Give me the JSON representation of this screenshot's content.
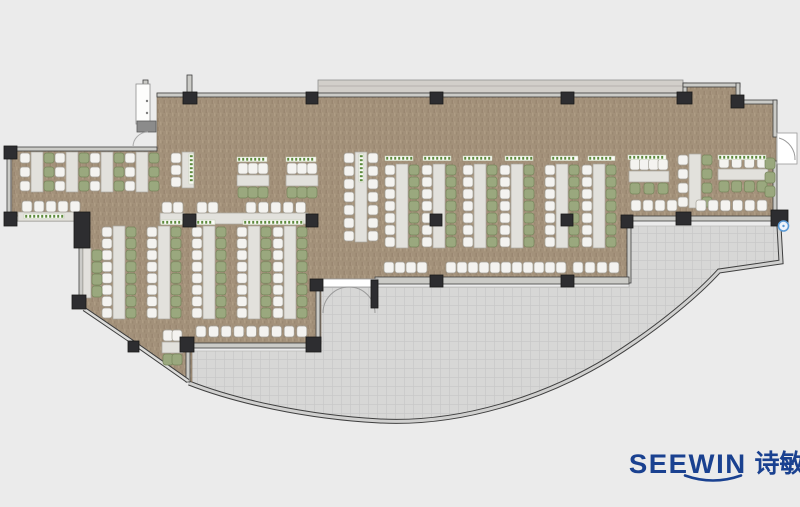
{
  "meta": {
    "type": "office-floor-plan",
    "description": "Open office cafeteria floor plan with desk clusters, curved curtain-wall terrace"
  },
  "logo": {
    "latin": "SEEWIN",
    "cjk": "诗敏",
    "color": "#1a4190"
  },
  "palette": {
    "background": "#ebebeb",
    "carpet": "#a3917a",
    "carpet_dark": "#917f68",
    "carpet_light": "#b5a38c",
    "terrace": "#d7d7d6",
    "terrace_grid": "#c8c8c7",
    "wall_fill": "#cbcbc7",
    "wall_line": "#3f3f3f",
    "column": "#2d2d30",
    "desk": "#e2e1dc",
    "desk_line": "#a9a79f",
    "chair_white": "#f4f3f0",
    "chair_white_line": "#a29f96",
    "chair_green": "#9aa87e",
    "chair_green_line": "#76855b",
    "label_green": "#5c8a3c",
    "ledge": "#d2cfca",
    "marker_blue": "#5b9bd5",
    "door_white": "#ffffff"
  },
  "plan": {
    "floor_path": "M157,93 L683,93 L683,83 L737,83 L737,101 L776,101 L776,219 L629,219 L629,282 L321,282 L321,344 L192,344 L192,382 L131,341 L84,308 L84,221 L12,221 L12,151 L157,151 Z",
    "terrace_path": "M190,351 L317,351 L317,287 L629,287 L629,226 L778,226 L780,262 L719,271 C700,292 660,327 610,358 C545,398 460,425 380,421 C305,417 235,401 190,383 Z",
    "arc_path": "M189,383 C235,401 305,417 380,421 C460,425 545,398 610,358 C660,327 700,292 719,271 L781,262 L779,226",
    "glass_points": "84,309 131,341 188,381",
    "ledge": [
      318,
      80,
      365,
      13
    ],
    "walls": [
      [
        157,
        93,
        526,
        4
      ],
      [
        683,
        83,
        4,
        14
      ],
      [
        683,
        83,
        57,
        4
      ],
      [
        736,
        83,
        4,
        21
      ],
      [
        736,
        100,
        41,
        4
      ],
      [
        773,
        100,
        4,
        37
      ],
      [
        773,
        161,
        4,
        53
      ],
      [
        627,
        216,
        150,
        5
      ],
      [
        627,
        221,
        4,
        62
      ],
      [
        375,
        277,
        254,
        7
      ],
      [
        316,
        287,
        4,
        53
      ],
      [
        191,
        343,
        127,
        5
      ],
      [
        186,
        348,
        4,
        34
      ],
      [
        79,
        244,
        4,
        56
      ],
      [
        12,
        216,
        66,
        5
      ],
      [
        7,
        152,
        4,
        66
      ],
      [
        7,
        147,
        150,
        4
      ],
      [
        143,
        80,
        5,
        44
      ],
      [
        187,
        75,
        5,
        18
      ]
    ],
    "columns": [
      [
        183,
        92,
        14,
        12
      ],
      [
        306,
        92,
        12,
        12
      ],
      [
        430,
        92,
        13,
        12
      ],
      [
        561,
        92,
        13,
        12
      ],
      [
        677,
        92,
        15,
        12
      ],
      [
        731,
        95,
        13,
        13
      ],
      [
        771,
        210,
        17,
        16
      ],
      [
        676,
        212,
        15,
        13
      ],
      [
        621,
        215,
        12,
        13
      ],
      [
        430,
        275,
        13,
        12
      ],
      [
        561,
        275,
        13,
        12
      ],
      [
        430,
        214,
        12,
        12
      ],
      [
        561,
        214,
        12,
        12
      ],
      [
        306,
        214,
        12,
        13
      ],
      [
        183,
        214,
        13,
        13
      ],
      [
        4,
        146,
        13,
        13
      ],
      [
        4,
        212,
        13,
        14
      ],
      [
        74,
        212,
        16,
        36
      ],
      [
        72,
        295,
        14,
        14
      ],
      [
        128,
        341,
        11,
        11
      ],
      [
        180,
        337,
        14,
        15
      ],
      [
        306,
        337,
        15,
        15
      ],
      [
        310,
        279,
        13,
        12
      ],
      [
        371,
        280,
        7,
        28
      ]
    ],
    "cabinet": {
      "rect": [
        136,
        84,
        14,
        40
      ],
      "knobs": [
        [
          147,
          101
        ],
        [
          147,
          113
        ]
      ],
      "block": [
        137,
        121,
        19,
        11
      ]
    },
    "vclusters": [
      {
        "x": 31,
        "y": 152,
        "h": 40,
        "n": 3,
        "left": "white",
        "right": "green"
      },
      {
        "x": 66,
        "y": 152,
        "h": 40,
        "n": 3,
        "left": "white",
        "right": "green"
      },
      {
        "x": 101,
        "y": 152,
        "h": 40,
        "n": 3,
        "left": "white",
        "right": "green"
      },
      {
        "x": 136,
        "y": 152,
        "h": 40,
        "n": 3,
        "left": "white",
        "right": "green"
      },
      {
        "x": 182,
        "y": 152,
        "h": 36,
        "n": 3,
        "left": "white",
        "right": null
      },
      {
        "x": 355,
        "y": 152,
        "h": 90,
        "n": 7,
        "left": "white",
        "right": "white"
      },
      {
        "x": 113,
        "y": 226,
        "h": 93,
        "n": 8,
        "left": "white",
        "right": "green"
      },
      {
        "x": 158,
        "y": 226,
        "h": 93,
        "n": 8,
        "left": "white",
        "right": "green"
      },
      {
        "x": 203,
        "y": 226,
        "h": 93,
        "n": 8,
        "left": "white",
        "right": "green"
      },
      {
        "x": 248,
        "y": 226,
        "h": 93,
        "n": 8,
        "left": "white",
        "right": "green"
      },
      {
        "x": 284,
        "y": 226,
        "h": 93,
        "n": 8,
        "left": "white",
        "right": "green"
      },
      {
        "x": 396,
        "y": 164,
        "h": 84,
        "n": 7,
        "left": "white",
        "right": "green"
      },
      {
        "x": 433,
        "y": 164,
        "h": 84,
        "n": 7,
        "left": "white",
        "right": "green"
      },
      {
        "x": 474,
        "y": 164,
        "h": 84,
        "n": 7,
        "left": "white",
        "right": "green"
      },
      {
        "x": 511,
        "y": 164,
        "h": 84,
        "n": 7,
        "left": "white",
        "right": "green"
      },
      {
        "x": 556,
        "y": 164,
        "h": 84,
        "n": 7,
        "left": "white",
        "right": "green"
      },
      {
        "x": 593,
        "y": 164,
        "h": 84,
        "n": 7,
        "left": "white",
        "right": "green"
      },
      {
        "x": 689,
        "y": 154,
        "h": 54,
        "n": 4,
        "left": "white",
        "right": "green"
      }
    ],
    "hclusters": [
      {
        "x": 237,
        "y": 175,
        "w": 32,
        "above": 3,
        "below": 3
      },
      {
        "x": 286,
        "y": 175,
        "w": 32,
        "above": 3,
        "below": 3
      },
      {
        "x": 629,
        "y": 171,
        "w": 40,
        "above": 4,
        "below": 3
      },
      {
        "x": 718,
        "y": 169,
        "w": 50,
        "above": 4,
        "below": 4
      },
      {
        "x": 162,
        "y": 342,
        "w": 21,
        "above": 2,
        "below": 2,
        "below_color": "green"
      }
    ],
    "desks": [
      [
        18,
        212,
        59,
        9
      ],
      [
        160,
        213,
        24,
        11
      ],
      [
        196,
        213,
        112,
        11
      ],
      [
        83,
        248,
        8,
        50
      ]
    ],
    "chair_rows": [
      {
        "x": 22,
        "y": 201,
        "n": 5,
        "p": 12,
        "c": "white"
      },
      {
        "x": 162,
        "y": 202,
        "n": 2,
        "p": 11,
        "c": "white"
      },
      {
        "x": 197,
        "y": 202,
        "n": 2,
        "p": 11,
        "c": "white"
      },
      {
        "x": 246,
        "y": 202,
        "n": 5,
        "p": 12.4,
        "c": "white"
      },
      {
        "x": 196,
        "y": 326,
        "n": 9,
        "p": 12.6,
        "c": "white"
      },
      {
        "x": 384,
        "y": 262,
        "n": 4,
        "p": 11,
        "c": "white"
      },
      {
        "x": 446,
        "y": 262,
        "n": 11,
        "p": 11,
        "c": "white"
      },
      {
        "x": 573,
        "y": 262,
        "n": 4,
        "p": 12,
        "c": "white"
      },
      {
        "x": 631,
        "y": 200,
        "n": 4,
        "p": 12,
        "c": "white"
      },
      {
        "x": 696,
        "y": 200,
        "n": 6,
        "p": 12.2,
        "c": "white"
      }
    ],
    "chair_cols": [
      {
        "x": 92,
        "y": 250,
        "n": 4,
        "p": 12,
        "c": "green"
      },
      {
        "x": 765,
        "y": 158,
        "n": 3,
        "p": 14,
        "c": "green"
      }
    ],
    "labels_h": [
      [
        24,
        214,
        40
      ],
      [
        237,
        157,
        30
      ],
      [
        286,
        157,
        30
      ],
      [
        161,
        220,
        21
      ],
      [
        196,
        220,
        19
      ],
      [
        243,
        220,
        60
      ],
      [
        385,
        156,
        28
      ],
      [
        423,
        156,
        28
      ],
      [
        463,
        156,
        29
      ],
      [
        505,
        156,
        28
      ],
      [
        551,
        156,
        27
      ],
      [
        588,
        156,
        27
      ],
      [
        628,
        155,
        38
      ],
      [
        718,
        155,
        48
      ]
    ],
    "labels_v": [
      [
        189,
        154,
        30
      ],
      [
        359,
        154,
        28
      ]
    ],
    "doors": {
      "south": {
        "lintel": [
          321,
          279,
          57,
          8
        ],
        "arcs": [
          "M349,287 A26,26 0 0 0 323,313",
          "M349,287 A26,26 0 0 1 375,313"
        ]
      },
      "east": {
        "leaf": [
          777,
          133,
          20,
          31
        ],
        "arc": "M779,138 A22,22 0 0 1 795,160"
      },
      "west": {
        "arc": "M148,132 A15,15 0 0 0 133,147"
      }
    },
    "marker": {
      "cx": 783.5,
      "cy": 226,
      "r": 5
    }
  }
}
